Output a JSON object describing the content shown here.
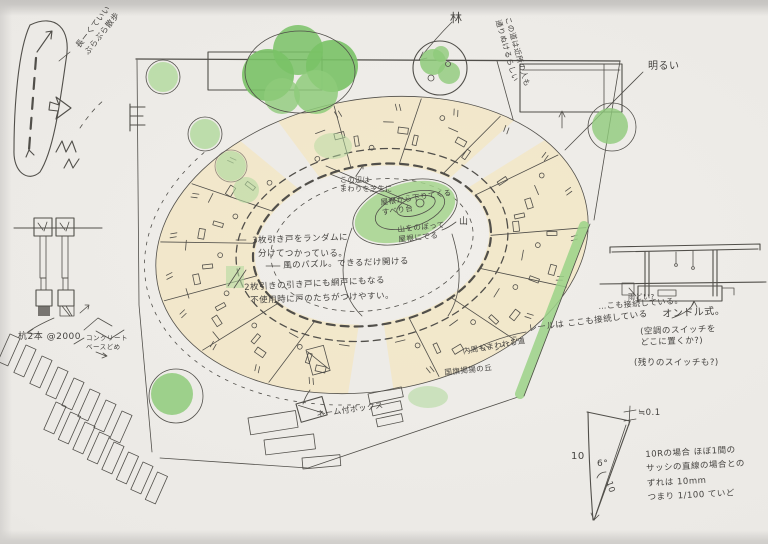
{
  "colors": {
    "paper": "#edebe7",
    "pencil": "#514f4a",
    "ink": "#454340",
    "tree-dark": "#79c266",
    "tree-mid": "#8ecb7a",
    "tree-light": "#b4daa0",
    "band": "#f2e6c6",
    "hedge": "#9bd287"
  },
  "site": {
    "promenade_note": "長ーくていい\nぶらぶら散歩",
    "forest_label": "林",
    "path_note": "この道は近所の人も\n通りぬけるらしい",
    "bright_label": "明るい"
  },
  "courtyard": {
    "area_note": "この辺は\nまわりを芝生に",
    "slide_note": "屋根から下りてくる\nすべり台",
    "hill_note": "山をのぼって\n屋根にでる",
    "hill_label": "山"
  },
  "doors_notes": {
    "line1": "3枚引き戸をランダムに",
    "line2": "分けてつかっている。",
    "line3": "風のパズル。できるだけ開ける",
    "line4": "2枚引きの引き戸にも網戸にもなる",
    "line5": "不使用時に戸のたちがつけやすい。"
  },
  "rail": {
    "note": "レールは ここも接続している",
    "note2": "…こも接続している。"
  },
  "section": {
    "gutter_label": "雨どい?",
    "ondol_label": "オンドル式。",
    "switch_note": "(空調のスイッチを\nどこに置くか?)",
    "switch_note2": "(残りのスイッチも?)"
  },
  "details": {
    "posts_note": "杭2本 @2000",
    "concrete_note": "コンクリート\nベースどめ",
    "box_label": "ネーム付ボックス",
    "inner_path_note": "内周もまわれる道",
    "flag_note": "国旗掲揚の丘"
  },
  "slope_diagram": {
    "height_label": "10",
    "angle_label": "6°",
    "hyp_label": "10",
    "offset_label": "≒0.1",
    "note": "10Rの場合 ほぼ1間の\nサッシの直線の場合との\nずれは 10mm\nつまり 1/100 ていど"
  }
}
